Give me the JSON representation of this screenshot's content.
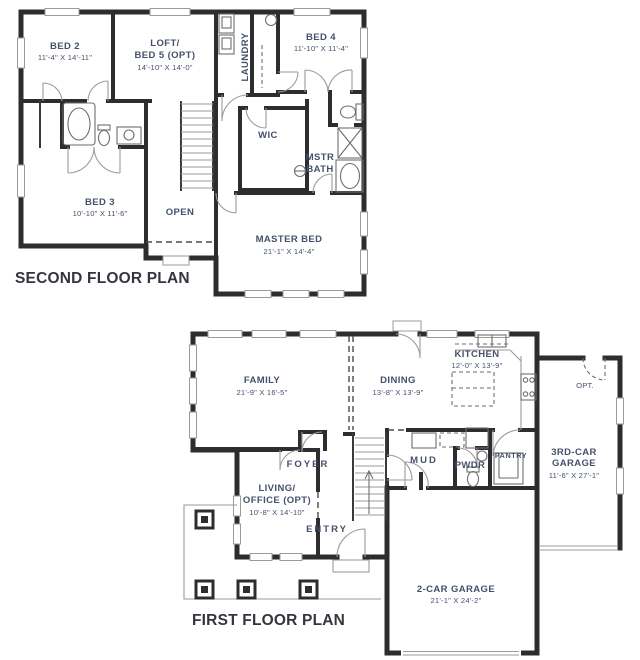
{
  "colors": {
    "wall": "#2d2d2f",
    "label_text": "#46506b",
    "title_text": "#33363c",
    "thin_line": "#9b9b9b",
    "background": "#ffffff"
  },
  "second_floor": {
    "title": "SECOND FLOOR PLAN",
    "bed2": {
      "name": "BED 2",
      "dims": "11'-4\" X 14'-11\""
    },
    "loft": {
      "name1": "LOFT/",
      "name2": "BED 5 (OPT)",
      "dims": "14'-10\" X 14'-0\""
    },
    "laundry": {
      "name": "LAUNDRY"
    },
    "bed4": {
      "name": "BED 4",
      "dims": "11'-10\" X 11'-4\""
    },
    "wic": {
      "name": "WIC"
    },
    "mstr_bath": {
      "name1": "MSTR",
      "name2": "BATH"
    },
    "bed3": {
      "name": "BED 3",
      "dims": "10'-10\" X 11'-6\""
    },
    "open": {
      "name": "OPEN"
    },
    "master_bed": {
      "name": "MASTER BED",
      "dims": "21'-1\" X 14'-4\""
    }
  },
  "first_floor": {
    "title": "FIRST FLOOR PLAN",
    "family": {
      "name": "FAMILY",
      "dims": "21'-9\" X 16'-5\""
    },
    "dining": {
      "name": "DINING",
      "dims": "13'-8\" X 13'-9\""
    },
    "kitchen": {
      "name": "KITCHEN",
      "dims": "12'-0\" X 13'-9\""
    },
    "opt_door": {
      "name": "OPT."
    },
    "third_car_garage": {
      "name1": "3RD-CAR",
      "name2": "GARAGE",
      "dims": "11'-6\" X 27'-1\""
    },
    "foyer": {
      "name": "FOYER"
    },
    "mud": {
      "name": "MUD"
    },
    "pwdr": {
      "name": "PWDR"
    },
    "pantry": {
      "name": "PANTRY"
    },
    "living_office": {
      "name1": "LIVING/",
      "name2": "OFFICE (OPT)",
      "dims": "10'-8\" X 14'-10\""
    },
    "entry": {
      "name": "ENTRY"
    },
    "two_car_garage": {
      "name": "2-CAR GARAGE",
      "dims": "21'-1\" X 24'-2\""
    }
  }
}
